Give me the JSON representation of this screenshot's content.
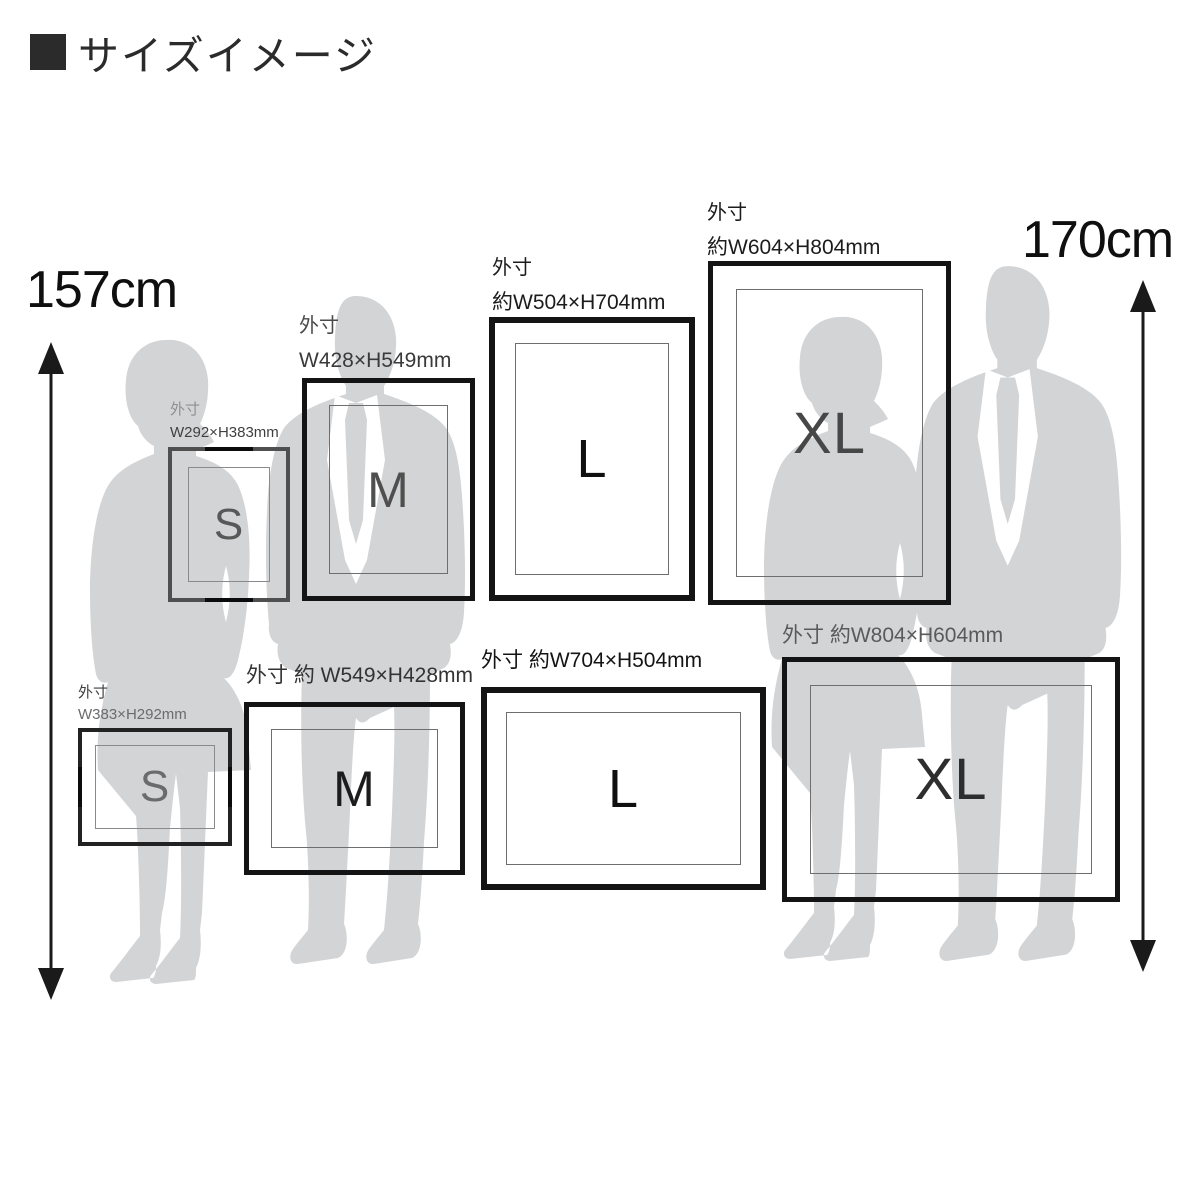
{
  "title": {
    "text": "サイズイメージ"
  },
  "height_markers": {
    "left": {
      "label": "157cm"
    },
    "right": {
      "label": "170cm"
    }
  },
  "frames": {
    "portrait_s": {
      "letter": "S",
      "line1": "外寸",
      "line2": "W292×H383mm"
    },
    "portrait_m": {
      "letter": "M",
      "line1": "外寸",
      "line2": "W428×H549mm"
    },
    "portrait_l": {
      "letter": "L",
      "line1": "外寸",
      "line2": "約W504×H704mm"
    },
    "portrait_xl": {
      "letter": "XL",
      "line1": "外寸",
      "line2": "約W604×H804mm"
    },
    "landscape_s": {
      "letter": "S",
      "line1": "外寸",
      "line2": "W383×H292mm"
    },
    "landscape_m": {
      "letter": "M",
      "line1": "外寸 約 W549×H428mm"
    },
    "landscape_l": {
      "letter": "L",
      "line1": "外寸 約W704×H504mm"
    },
    "landscape_xl": {
      "letter": "XL",
      "line1": "外寸 約W804×H604mm"
    }
  },
  "colors": {
    "background": "#ffffff",
    "silhouette": "#d3d4d6",
    "frame_border": "#141414",
    "s_frame_border": "#4f4f4f",
    "mat_line": "#6e6e6e",
    "text_dark": "#1c1c1c",
    "text_gray": "#8f8f8f",
    "arrow": "#1a1a1a"
  }
}
